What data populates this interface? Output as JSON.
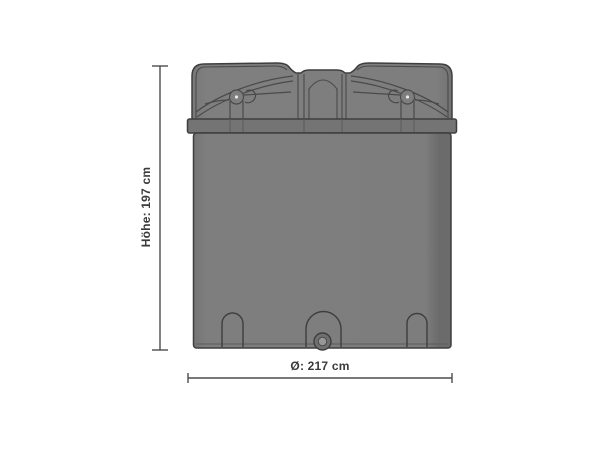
{
  "diagram": {
    "kind": "storage-tank-dimension-drawing",
    "dimensions": {
      "height_label": "Höhe: 197 cm",
      "diameter_label": "Ø: 217 cm"
    },
    "colors": {
      "background": "#ffffff",
      "tank_body": "#7e7e7e",
      "tank_lid": "#7e7e7e",
      "rim_band": "#747474",
      "outline": "#3e3e3e",
      "detail_line": "#4a4a4a",
      "dimension_line": "#4d4d4d",
      "label_text": "#3a3a3a",
      "drain_outer": "#6f6f6f",
      "drain_inner": "#989898"
    }
  }
}
